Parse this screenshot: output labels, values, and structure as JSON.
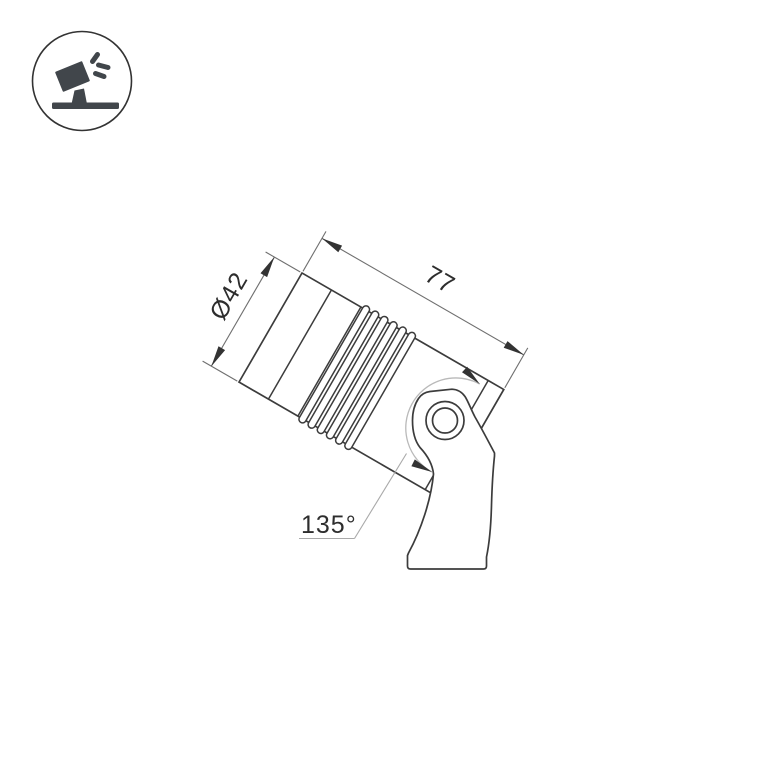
{
  "page": {
    "background_color": "#ffffff"
  },
  "corner_badge": {
    "icon": "adjustable-spotlight-icon",
    "description": "tilted spotlight head on a stand emitting three light rays, inside a circle",
    "circle_stroke_color": "#333333",
    "glyph_color": "#41464b"
  },
  "drawing": {
    "kind": "dimensioned outline drawing of an adjustable spotlight luminaire",
    "labels": {
      "diameter": "Ø42",
      "length": "77",
      "tilt_range": "135°"
    },
    "colors": {
      "outline": "#3c3c3c",
      "dimension_lines": "#6f6f6f",
      "arrowheads": "#333333",
      "rotation_arc": "#b9b9b9",
      "leader_line": "#a9a9a9",
      "label_text": "#2d2d2d"
    }
  }
}
